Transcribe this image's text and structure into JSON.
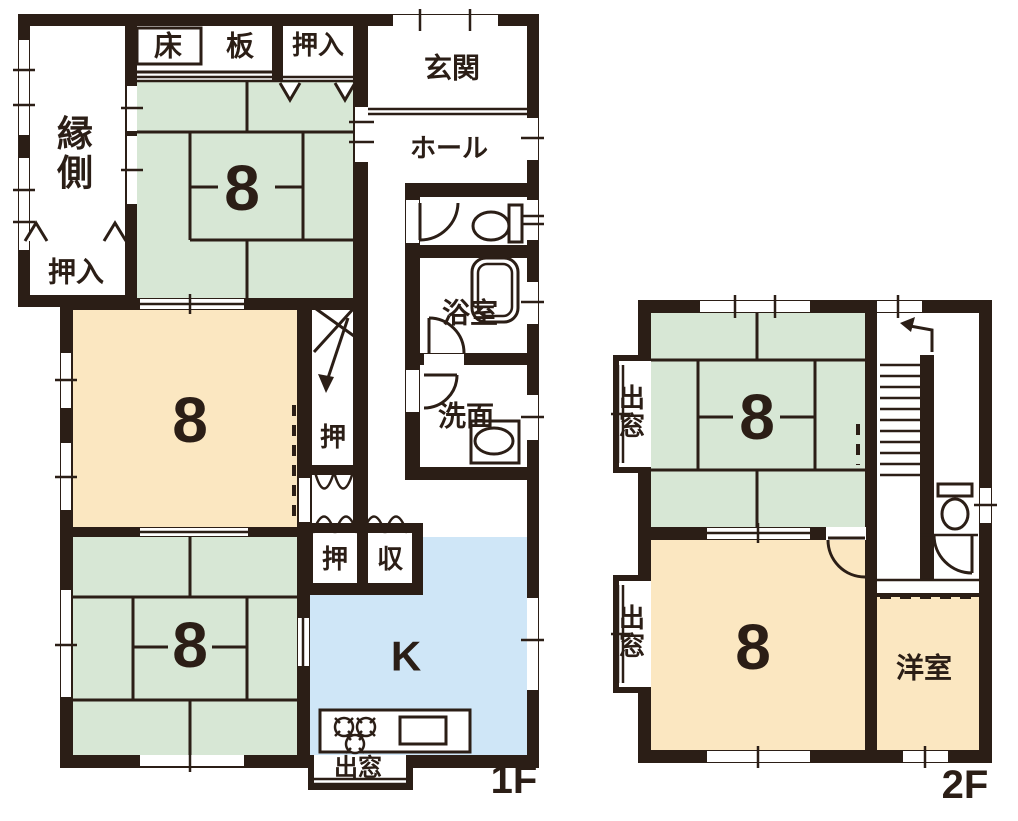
{
  "diagram_type": "floor-plan",
  "palette": {
    "wall_ink": "#2b1e16",
    "tatami_green": "#d7e7d5",
    "room_cream": "#fbe7c1",
    "kitchen_blue": "#cfe6f7",
    "background": "#ffffff"
  },
  "floor1": {
    "floor_label": "1F",
    "engawa": "縁側",
    "toko": "床",
    "ita": "板",
    "oshiire_top": "押入",
    "oshiire_west": "押入",
    "genkan": "玄関",
    "hall": "ホール",
    "bath": "浴室",
    "washroom": "洗面",
    "tatami_north_size": "8",
    "center_room_size": "8",
    "tatami_south_size": "8",
    "closet_mid": "押",
    "closet_small": "押",
    "storage_small": "収",
    "kitchen": "K",
    "bay_window": "出窓"
  },
  "floor2": {
    "floor_label": "2F",
    "tatami_size": "8",
    "bedroom_size": "8",
    "bay_window_upper": "出窓",
    "bay_window_lower": "出窓",
    "western_room": "洋室"
  }
}
